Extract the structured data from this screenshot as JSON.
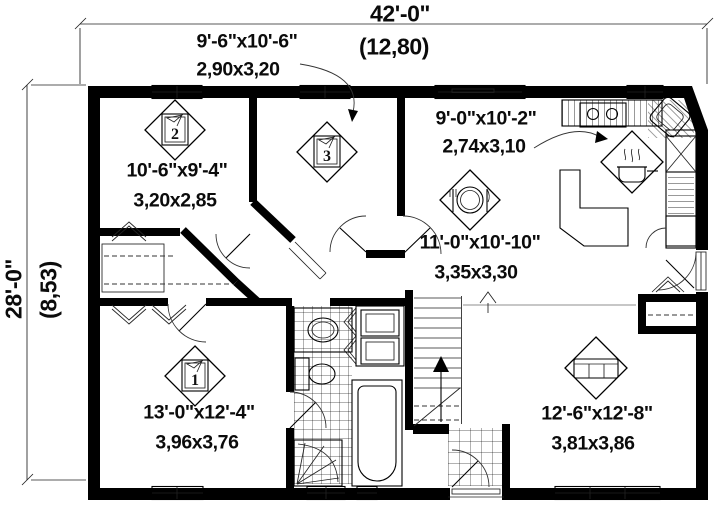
{
  "plan_title": "single-storey house floor plan",
  "dimensions": {
    "width_imperial": "42'-0\"",
    "width_metric": "(12,80)",
    "height_imperial": "28'-0\"",
    "height_metric": "(8,53)"
  },
  "rooms": {
    "bedroom2": {
      "marker": "2",
      "imperial": "10'-6\"x9'-4\"",
      "metric": "3,20x2,85"
    },
    "bedroom3": {
      "marker": "3",
      "imperial": "9'-6\"x10'-6\"",
      "metric": "2,90x3,20"
    },
    "kitchen": {
      "imperial": "9'-0\"x10'-2\"",
      "metric": "2,74x3,10"
    },
    "dining": {
      "imperial": "11'-0\"x10'-10\"",
      "metric": "3,35x3,30"
    },
    "bedroom1": {
      "marker": "1",
      "imperial": "13'-0\"x12'-4\"",
      "metric": "3,96x3,76"
    },
    "living": {
      "imperial": "12'-6\"x12'-8\"",
      "metric": "3,81x3,86"
    }
  },
  "icons": {
    "room_marker": "numbered diamond with pennant",
    "dining_icon": "plate with fork and knife",
    "kitchen_icon": "steaming cooking pot",
    "living_icon": "sofa",
    "fixtures": [
      "stove",
      "corner-sink",
      "dishwasher",
      "refrigerator",
      "vanity-sink",
      "toilet",
      "bathtub",
      "corner-shower",
      "washer-dryer",
      "stairs-up-arrow"
    ]
  },
  "colors": {
    "walls": "#000000",
    "background": "#ffffff",
    "thin_lines": "#333333",
    "floor_break": "#8f8f8f"
  }
}
